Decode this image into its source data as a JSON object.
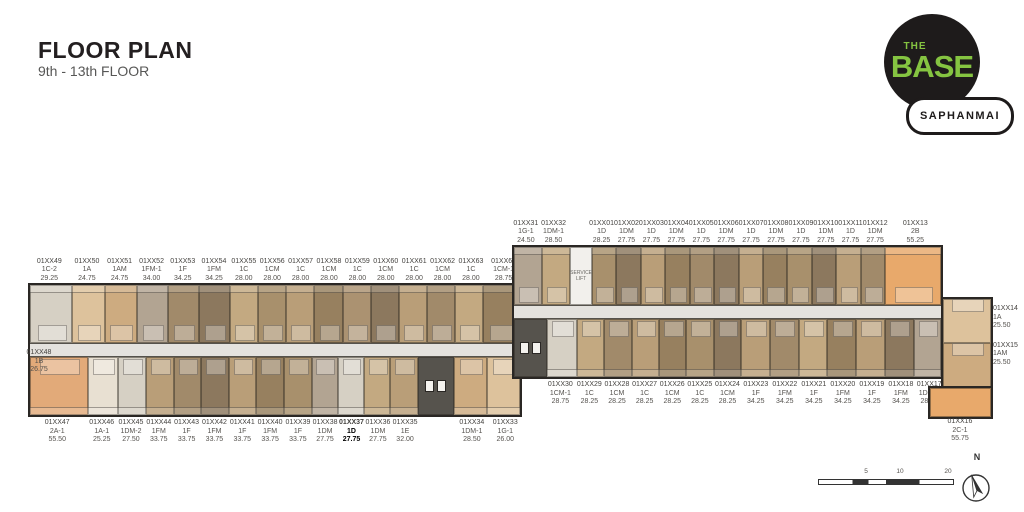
{
  "header": {
    "title": "FLOOR PLAN",
    "subtitle": "9th - 13th FLOOR"
  },
  "logo": {
    "the": "THE",
    "base": "BASE",
    "location": "SAPHANMAI",
    "brand_green": "#85c441",
    "brand_black": "#1e1b1b"
  },
  "scale_bar": {
    "ticks": [
      "5",
      "10",
      "20"
    ]
  },
  "compass": {
    "label": "N"
  },
  "service_lift_label": "SERVICE\nLIFT",
  "wings": [
    {
      "name": "left-wing-floorplan",
      "id": "wing-left",
      "top_units": [
        {
          "no": "01XX49",
          "type": "1C-2",
          "area": "29.25",
          "color": "#d6d0c4",
          "w": 1.5
        },
        {
          "no": "01XX50",
          "type": "1A",
          "area": "24.75",
          "color": "#ddc29c",
          "w": 1.15
        },
        {
          "no": "01XX51",
          "type": "1AM",
          "area": "24.75",
          "color": "#cdab80",
          "w": 1.15
        },
        {
          "no": "01XX52",
          "type": "1FM-1",
          "area": "34.00",
          "color": "#b2a492",
          "w": 1.1
        },
        {
          "no": "01XX53",
          "type": "1F",
          "area": "34.25",
          "color": "#a18a6a",
          "w": 1.1
        },
        {
          "no": "01XX54",
          "type": "1FM",
          "area": "34.25",
          "color": "#8c785e",
          "w": 1.1
        },
        {
          "no": "01XX55",
          "type": "1C",
          "area": "28.00",
          "color": "#c3a981",
          "w": 1.0
        },
        {
          "no": "01XX56",
          "type": "1CM",
          "area": "28.00",
          "color": "#a8906c",
          "w": 1.0
        },
        {
          "no": "01XX57",
          "type": "1C",
          "area": "28.00",
          "color": "#b99e78",
          "w": 1.0
        },
        {
          "no": "01XX58",
          "type": "1CM",
          "area": "28.00",
          "color": "#97805f",
          "w": 1.0
        },
        {
          "no": "01XX59",
          "type": "1C",
          "area": "28.00",
          "color": "#ab9271",
          "w": 1.0
        },
        {
          "no": "01XX60",
          "type": "1CM",
          "area": "28.00",
          "color": "#8c785e",
          "w": 1.0
        },
        {
          "no": "01XX61",
          "type": "1C",
          "area": "28.00",
          "color": "#b99e78",
          "w": 1.0
        },
        {
          "no": "01XX62",
          "type": "1CM",
          "area": "28.00",
          "color": "#a18a6a",
          "w": 1.0
        },
        {
          "no": "01XX63",
          "type": "1C",
          "area": "28.00",
          "color": "#c3a981",
          "w": 1.0
        },
        {
          "no": "01XX64",
          "type": "1CM-1",
          "area": "28.75",
          "color": "#97805f",
          "w": 1.3
        }
      ],
      "bottom_units": [
        {
          "no": "01XX47",
          "type": "2A-1",
          "area": "55.50",
          "color": "#e2aa79",
          "w": 2.1
        },
        {
          "no": "01XX46",
          "type": "1A-1",
          "area": "25.25",
          "color": "#e8e0d2",
          "w": 1.1
        },
        {
          "no": "01XX45",
          "type": "1DM-2",
          "area": "27.50",
          "color": "#d6d0c4",
          "w": 1.0
        },
        {
          "no": "01XX44",
          "type": "1FM",
          "area": "33.75",
          "color": "#b99e78",
          "w": 1.0
        },
        {
          "no": "01XX43",
          "type": "1F",
          "area": "33.75",
          "color": "#a18a6a",
          "w": 1.0
        },
        {
          "no": "01XX42",
          "type": "1FM",
          "area": "33.75",
          "color": "#8c785e",
          "w": 1.0
        },
        {
          "no": "01XX41",
          "type": "1F",
          "area": "33.75",
          "color": "#b99e78",
          "w": 1.0
        },
        {
          "no": "01XX40",
          "type": "1FM",
          "area": "33.75",
          "color": "#97805f",
          "w": 1.0
        },
        {
          "no": "01XX39",
          "type": "1F",
          "area": "33.75",
          "color": "#a8906c",
          "w": 1.0
        },
        {
          "no": "01XX38",
          "type": "1DM",
          "area": "27.75",
          "color": "#b2a492",
          "w": 0.95
        },
        {
          "no": "01XX37",
          "type": "1D",
          "area": "27.75",
          "color": "#d6d0c4",
          "w": 0.95,
          "highlight": true
        },
        {
          "no": "01XX36",
          "type": "1DM",
          "area": "27.75",
          "color": "#c3a981",
          "w": 0.95
        },
        {
          "no": "01XX35",
          "type": "1E",
          "area": "32.00",
          "color": "#b99e78",
          "w": 1.0
        },
        {
          "core": true,
          "color": "#56534d",
          "w": 1.3
        },
        {
          "no": "01XX34",
          "type": "1DM-1",
          "area": "28.50",
          "color": "#cdab80",
          "w": 1.2
        },
        {
          "no": "01XX33",
          "type": "1G-1",
          "area": "26.00",
          "color": "#ddc29c",
          "w": 1.2
        }
      ]
    },
    {
      "name": "right-wing-floorplan",
      "id": "wing-right",
      "top_units": [
        {
          "no": "01XX31",
          "type": "1G-1",
          "area": "24.50",
          "color": "#b2a492",
          "w": 1.15
        },
        {
          "no": "01XX32",
          "type": "1DM-1",
          "area": "28.50",
          "color": "#c3a981",
          "w": 1.15
        },
        {
          "service": true,
          "color": "#f2f0ec",
          "w": 0.9
        },
        {
          "no": "01XX01",
          "type": "1D",
          "area": "28.25",
          "color": "#a8906c",
          "w": 1.0
        },
        {
          "no": "01XX02",
          "type": "1DM",
          "area": "27.75",
          "color": "#8c785e",
          "w": 1.0
        },
        {
          "no": "01XX03",
          "type": "1D",
          "area": "27.75",
          "color": "#b99e78",
          "w": 1.0
        },
        {
          "no": "01XX04",
          "type": "1DM",
          "area": "27.75",
          "color": "#97805f",
          "w": 1.0
        },
        {
          "no": "01XX05",
          "type": "1D",
          "area": "27.75",
          "color": "#a18a6a",
          "w": 1.0
        },
        {
          "no": "01XX06",
          "type": "1DM",
          "area": "27.75",
          "color": "#8c785e",
          "w": 1.0
        },
        {
          "no": "01XX07",
          "type": "1D",
          "area": "27.75",
          "color": "#b99e78",
          "w": 1.0
        },
        {
          "no": "01XX08",
          "type": "1DM",
          "area": "27.75",
          "color": "#97805f",
          "w": 1.0
        },
        {
          "no": "01XX09",
          "type": "1D",
          "area": "27.75",
          "color": "#a8906c",
          "w": 1.0
        },
        {
          "no": "01XX10",
          "type": "1DM",
          "area": "27.75",
          "color": "#8c785e",
          "w": 1.0
        },
        {
          "no": "01XX11",
          "type": "1D",
          "area": "27.75",
          "color": "#b99e78",
          "w": 1.0
        },
        {
          "no": "01XX12",
          "type": "1DM",
          "area": "27.75",
          "color": "#a18a6a",
          "w": 1.0
        },
        {
          "no": "01XX13",
          "type": "2B",
          "area": "55.25",
          "color": "#e8a96b",
          "w": 2.3
        }
      ],
      "bottom_units": [
        {
          "core": true,
          "color": "#56534d",
          "w": 1.2
        },
        {
          "no": "01XX30",
          "type": "1CM-1",
          "area": "28.75",
          "color": "#d6d0c4",
          "w": 1.1
        },
        {
          "no": "01XX29",
          "type": "1C",
          "area": "28.25",
          "color": "#c3a981",
          "w": 1.0
        },
        {
          "no": "01XX28",
          "type": "1CM",
          "area": "28.25",
          "color": "#a18a6a",
          "w": 1.0
        },
        {
          "no": "01XX27",
          "type": "1C",
          "area": "28.25",
          "color": "#b99e78",
          "w": 1.0
        },
        {
          "no": "01XX26",
          "type": "1CM",
          "area": "28.25",
          "color": "#97805f",
          "w": 1.0
        },
        {
          "no": "01XX25",
          "type": "1C",
          "area": "28.25",
          "color": "#a8906c",
          "w": 1.0
        },
        {
          "no": "01XX24",
          "type": "1CM",
          "area": "28.25",
          "color": "#8c785e",
          "w": 1.0
        },
        {
          "no": "01XX23",
          "type": "1F",
          "area": "34.25",
          "color": "#b99e78",
          "w": 1.05
        },
        {
          "no": "01XX22",
          "type": "1FM",
          "area": "34.25",
          "color": "#a18a6a",
          "w": 1.05
        },
        {
          "no": "01XX21",
          "type": "1F",
          "area": "34.25",
          "color": "#c3a981",
          "w": 1.05
        },
        {
          "no": "01XX20",
          "type": "1FM",
          "area": "34.25",
          "color": "#97805f",
          "w": 1.05
        },
        {
          "no": "01XX19",
          "type": "1F",
          "area": "34.25",
          "color": "#b99e78",
          "w": 1.05
        },
        {
          "no": "01XX18",
          "type": "1FM",
          "area": "34.25",
          "color": "#8c785e",
          "w": 1.05
        },
        {
          "no": "01XX17",
          "type": "1DM-2",
          "area": "28.25",
          "color": "#b2a492",
          "w": 1.0
        }
      ]
    }
  ],
  "side_units": {
    "right_column": [
      {
        "no": "01XX14",
        "type": "1A",
        "area": "25.50",
        "color": "#ddc29c"
      },
      {
        "no": "01XX15",
        "type": "1AM",
        "area": "25.50",
        "color": "#cdab80"
      }
    ],
    "unit16": {
      "no": "01XX16",
      "type": "2C-1",
      "area": "55.75",
      "color": "#e8a96b"
    },
    "unit48": {
      "no": "01XX48",
      "type": "1B",
      "area": "26.75"
    }
  }
}
